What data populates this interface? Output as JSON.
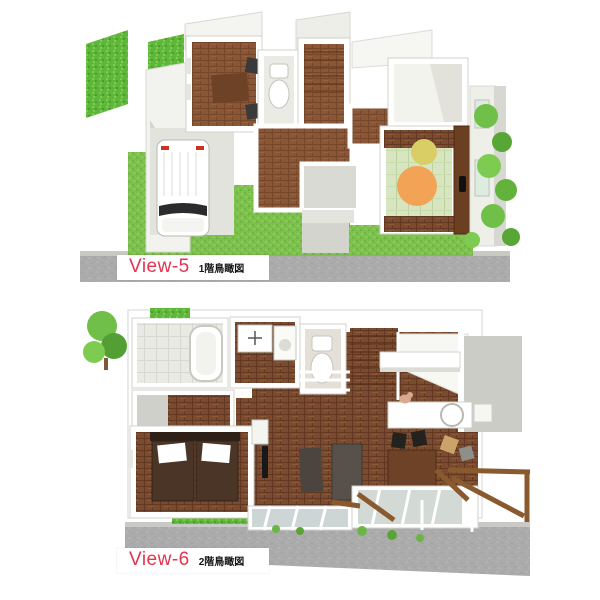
{
  "views": [
    {
      "label": "View-5",
      "sublabel": "1階鳥瞰図"
    },
    {
      "label": "View-6",
      "sublabel": "2階鳥瞰図"
    }
  ],
  "palette": {
    "background": "#ffffff",
    "label_red": "#e23350",
    "wood_floor_1f": "#8a5636",
    "wood_floor_2f": "#7b4b2f",
    "grass_green": "#7cc04d",
    "hedge_green": "#5fb63a",
    "concrete_gray": "#ababab",
    "tatami_green": "#d7e6c0",
    "round_table_orange": "#f2a355",
    "cushion_yellow": "#d9cd66",
    "car_body": "#ffffff"
  }
}
